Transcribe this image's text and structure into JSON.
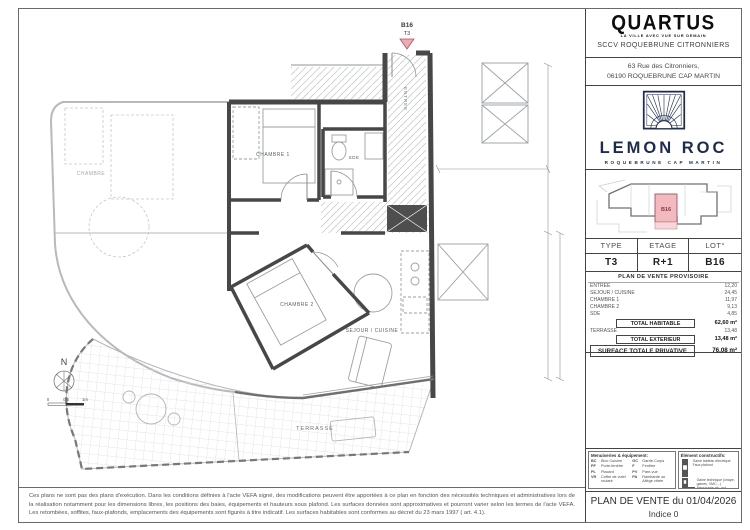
{
  "brand": {
    "name": "QUARTUS",
    "tagline": "LA VILLE AVEC VUE SUR DEMAIN",
    "company": "SCCV ROQUEBRUNE CITRONNIERS",
    "address1": "63 Rue des Citronniers,",
    "address2": "06190 ROQUEBRUNE CAP MARTIN"
  },
  "project": {
    "name": "LEMON ROC",
    "location": "ROQUEBRUNE CAP MARTIN"
  },
  "keyplan": {
    "unit": "B16",
    "highlight_color": "#f2b9be"
  },
  "unit_table": {
    "h_type": "TYPE",
    "h_etage": "ETAGE",
    "h_lot": "LOT°",
    "type": "T3",
    "etage": "R+1",
    "lot": "B16"
  },
  "surfaces": {
    "title": "PLAN DE VENTE PROVISOIRE",
    "rows": [
      {
        "label": "ENTREE",
        "value": "12,20"
      },
      {
        "label": "SEJOUR / CUISINE",
        "value": "24,45"
      },
      {
        "label": "CHAMBRE 1",
        "value": "11,97"
      },
      {
        "label": "CHAMBRE 2",
        "value": "9,13"
      },
      {
        "label": "SDE",
        "value": "4,85"
      }
    ],
    "total_habitable_label": "TOTAL HABITABLE",
    "total_habitable_value": "62,60 m²",
    "terrasse_label": "TERRASSE",
    "terrasse_value": "13,48",
    "total_ext_label": "TOTAL EXTERIEUR",
    "total_ext_value": "13,48 m²",
    "total_priv_label": "SURFACE TOTALE PRIVATIVE",
    "total_priv_value": "76,08 m²"
  },
  "legend_menuiseries": {
    "title": "Menuiseries & équipement:",
    "items": [
      {
        "abbr": "BC",
        "label": "Bloc Cuisine"
      },
      {
        "abbr": "GC",
        "label": "Garde-Corps"
      },
      {
        "abbr": "PF",
        "label": "Porte-fenêtre"
      },
      {
        "abbr": "F",
        "label": "Fenêtre"
      },
      {
        "abbr": "PL",
        "label": "Placard"
      },
      {
        "abbr": "PV",
        "label": "Pare-vue"
      },
      {
        "abbr": "VR",
        "label": "Coffre de volet roulant"
      },
      {
        "abbr": "PA",
        "label": "Rambarde ou Allège vitrée"
      }
    ]
  },
  "legend_elements": {
    "title": "Élément constructifs:",
    "items": [
      {
        "label": "Gaine tableau électrique"
      },
      {
        "label": "Faux plafond"
      },
      {
        "label": "Gaine technique (chape, gaines, VMC…)"
      },
      {
        "label": "Menuiserie alu. ext."
      }
    ]
  },
  "footer": {
    "title": "PLAN DE VENTE du 01/04/2026",
    "indice": "Indice 0"
  },
  "plan": {
    "marker_lot": "B16",
    "marker_type": "T3",
    "entree": "ENTREE",
    "chambre1": "CHAMBRE 1",
    "sde": "SDE",
    "chambre2": "CHAMBRE 2",
    "sejour": "SEJOUR / CUISINE",
    "terrasse": "TERRASSE",
    "neighbor_room": "CHAMBRE",
    "north": "N",
    "scale_zero": "0",
    "scale_half": "0,5",
    "scale_one": "1m"
  },
  "disclaimer": "Ces plans ne sont pas des plans d'exécution. Dans les conditions définies à l'acte VEFA signé, des modifications peuvent être apportées à ce plan en fonction des nécessités techniques et administratives lors de la réalisation notamment pour les dimensions libres, les positions des baies, équipements et hauteurs sous plafond. Les surfaces données sont approximatives et pourront varier selon les termes de l'acte VEFA. Les retombées, soffites, faux-plafonds, emplacements des équipements sont figurés à titre indicatif. Les surfaces habitables sont conformes au décret du 23 mars 1997 ( art. 4.1)."
}
